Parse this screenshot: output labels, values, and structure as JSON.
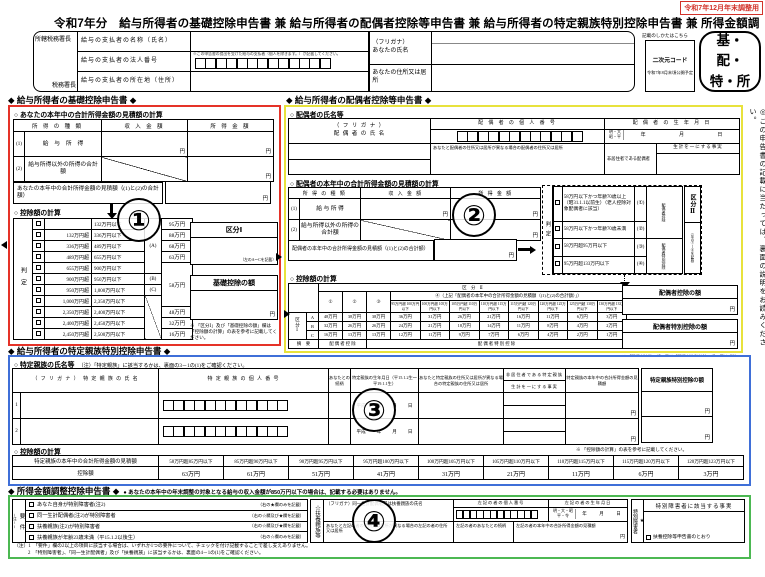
{
  "page": {
    "edition_note": "令和7年12月年末調整用",
    "title": "令和7年分　給与所得者の基礎控除申告書 兼 給与所得者の配偶者控除等申告書 兼 給与所得者の特定親族特別控除申告書 兼 所得金額調整控除申告書",
    "side_note": "◎この申告書の記載に当たっては、裏面の説明をお読みください。"
  },
  "header": {
    "tax_office_prefix": "所轄税務署長",
    "tax_office_suffix": "税務署長",
    "payer_name_label": "給与の支払者の名称（氏名）",
    "payer_number_label": "給与の支払者の法人番号",
    "payer_number_note": "※この申告書の提出を受けた給与の支払者（個人を除きます。）が記載してください。",
    "payer_address_label": "給与の支払者の所在地（住所）",
    "furigana_label": "（フリガナ）",
    "your_name_label": "あなたの氏名",
    "your_address_label": "あなたの住所又は居所",
    "qr_guide": "記載のしかたはこちら",
    "qr_label": "二次元コード",
    "qr_note": "令和7年8月末頃公開予定",
    "badge": "基・配・特・所"
  },
  "basic": {
    "heading": "◆ 給与所得者の基礎控除申告書 ◆",
    "income_title": "○ あなたの本年中の合計所得金額の見積額の計算",
    "col_type": "所 得 の 種 類",
    "col_revenue": "収 入 金 額",
    "col_amount": "所 得 金 額",
    "row1_no": "(1)",
    "row1_label": "給　与　所　得",
    "row2_no": "(2)",
    "row2_label": "給与所得以外の所得の合計額",
    "yen": "円",
    "total_label": "あなたの本年中の合計所得金額の見積額（(1)と(2)の合計額）",
    "deduction_title": "○ 控除額の計算",
    "judge_label": "判定",
    "judge_rows": [
      {
        "lo": "",
        "hi": "132万円以下"
      },
      {
        "lo": "132万円超",
        "hi": "336万円以下"
      },
      {
        "lo": "336万円超",
        "hi": "489万円以下"
      },
      {
        "lo": "489万円超",
        "hi": "655万円以下"
      },
      {
        "lo": "655万円超",
        "hi": "900万円以下"
      },
      {
        "lo": "900万円超",
        "hi": "950万円以下"
      },
      {
        "lo": "950万円超",
        "hi": "1,000万円以下"
      },
      {
        "lo": "1,000万円超",
        "hi": "2,350万円以下"
      },
      {
        "lo": "2,350万円超",
        "hi": "2,400万円以下"
      },
      {
        "lo": "2,400万円超",
        "hi": "2,450万円以下"
      },
      {
        "lo": "2,450万円超",
        "hi": "2,500万円以下"
      }
    ],
    "judge_marks": [
      {
        "text": "(A)",
        "span": 5
      },
      {
        "text": "(B)",
        "span": 1
      },
      {
        "text": "(C)",
        "span": 1
      },
      {
        "text": "",
        "span": 4
      }
    ],
    "judge_amounts": [
      {
        "text": "95万円",
        "span": 1
      },
      {
        "text": "88万円",
        "span": 1
      },
      {
        "text": "68万円",
        "span": 1
      },
      {
        "text": "63万円",
        "span": 1
      },
      {
        "text": "58万円",
        "span": 4
      },
      {
        "text": "48万円",
        "span": 1
      },
      {
        "text": "32万円",
        "span": 1
      },
      {
        "text": "16万円",
        "span": 1
      }
    ],
    "kubun1_label": "区分Ⅰ",
    "kubun1_hint": "（左のA～Cを記載）",
    "kiso_label": "基礎控除の額",
    "note": "※ 「区分Ⅰ」及び「基礎控除の額」欄は「控除額の計算」の表を参考に記載してください。",
    "circle": "①"
  },
  "spouse": {
    "heading": "◆ 給与所得者の配偶者控除等申告書 ◆",
    "name_title": "○ 配偶者の氏名等",
    "furigana_label": "（ フ リ ガ ナ ）",
    "name_label": "配 偶 者 の 氏 名",
    "number_label": "配 偶 者 の 個 人 番 号",
    "address_label": "あなたと配偶者の住所又は居所が異なる場合の配偶者の住所又は居所",
    "birth_label": "配 偶 者 の 生 年 月 日",
    "era1": "明・大",
    "era2": "昭・平",
    "year": "年",
    "month": "月",
    "day": "日",
    "nonresident_label": "非居住者である配偶者",
    "living_label": "生計を一にする事実",
    "income_title": "○ 配偶者の本年中の合計所得金額の見積額の計算",
    "col_type": "所 得 の 種 類",
    "col_revenue": "収 入 金 額",
    "col_amount": "所 得 金 額",
    "row1_no": "(1)",
    "row1_label": "給 与 所 得",
    "row2_no": "(2)",
    "row2_label": "給与所得以外の所得の合計額",
    "yen": "円",
    "total_label": "配偶者の本年中の合計所得金額の見積額（(1)と(2)の合計額）",
    "judge_label": "判定",
    "judge_rows": [
      {
        "label": "58万円以下かつ年齢70歳以上（昭31.1.1以前生）（老人控除対象配偶者に該当）",
        "mark": "(①)"
      },
      {
        "label": "58万円以下かつ年齢70歳未満",
        "mark": "(②)"
      },
      {
        "label": "58万円超95万円以下",
        "mark": "(③)"
      },
      {
        "label": "95万円超133万円以下",
        "mark": "(④)"
      }
    ],
    "judge_groups": [
      {
        "text": "配偶者控除",
        "span": 2
      },
      {
        "text": "配偶者特別控除",
        "span": 2
      }
    ],
    "kubun2_label": "区分Ⅱ",
    "kubun2_hint": "（左の①～④を記載）",
    "matrix_title": "○ 控除額の計算",
    "matrix": {
      "header": "区　分　Ⅱ",
      "cols123": [
        "①",
        "②",
        "③"
      ],
      "col4_header": "④（上記「配偶者の本年中の合計所得金額の見積額（(1)と(2)の合計額）」）",
      "col4_ranges": [
        "95万円超 100万円以下",
        "100万円超 105万円以下",
        "105万円超 110万円以下",
        "110万円超 115万円以下",
        "115万円超 120万円以下",
        "120万円超 125万円以下",
        "125万円超 130万円以下",
        "130万円超 133万円以下"
      ],
      "kubun1_label": "区分Ⅰ",
      "row_keys": [
        "A",
        "B",
        "C"
      ],
      "rows": [
        [
          "48万円",
          "38万円",
          "38万円",
          "36万円",
          "31万円",
          "26万円",
          "21万円",
          "16万円",
          "11万円",
          "6万円",
          "3万円"
        ],
        [
          "32万円",
          "26万円",
          "26万円",
          "24万円",
          "21万円",
          "18万円",
          "14万円",
          "11万円",
          "8万円",
          "4万円",
          "2万円"
        ],
        [
          "16万円",
          "13万円",
          "13万円",
          "12万円",
          "11万円",
          "9万円",
          "7万円",
          "6万円",
          "4万円",
          "2万円",
          "1万円"
        ]
      ],
      "summary_label": "摘　要",
      "summary1": "配 偶 者 控 除",
      "summary2": "配 偶 者 特 別 控 除"
    },
    "deduction1_label": "配偶者控除の額",
    "deduction2_label": "配偶者特別控除の額",
    "note": "※ 「配偶者控除の額」又は「配偶者特別控除の額」欄は「判定」及び「控除額の計算」の表を参考に記載してください。",
    "circle": "②"
  },
  "tokutei": {
    "heading": "◆ 給与所得者の特定親族特別控除申告書 ◆",
    "name_title": "○ 特定親族の氏名等",
    "name_note": "（注）「特定親族」に該当するかは、裏面の3－1の(1)をご確認ください。",
    "col_name": "（ フ リ ガ ナ ）　特 定 親 族 の 氏 名",
    "col_number": "特 定 親 族 の 個 人 番 号",
    "col_relation": "あなたとの続柄",
    "col_birth": "特定親族の生年月日（平15.1.2生～平19.1.1生）",
    "col_address": "あなたと特定親族の住所又は居所が異なる場合の特定親族の住所又は居所",
    "col_nonresident": "非居住者である特定親族",
    "col_living": "生計を一にする事実",
    "col_income": "特定親族の本年中の合計所得金額の見積額",
    "col_deduction": "特定親族特別控除の額",
    "row_numbers": [
      "1",
      "2"
    ],
    "era": "平成",
    "year": "年",
    "month": "月",
    "day": "日",
    "yen": "円",
    "note": "※ 「控除額の計算」の表を参考に記載してください。",
    "calc_title": "○ 控除額の計算",
    "calc_label": "特定親族の本年中の合計所得金額の見積額",
    "calc_row_label": "控除額",
    "ranges": [
      "58万円超85万円以下",
      "85万円超90万円以下",
      "90万円超95万円以下",
      "95万円超100万円以下",
      "100万円超105万円以下",
      "105万円超110万円以下",
      "110万円超115万円以下",
      "115万円超120万円以下",
      "120万円超123万円以下"
    ],
    "amounts": [
      "63万円",
      "61万円",
      "51万円",
      "41万円",
      "31万円",
      "21万円",
      "11万円",
      "6万円",
      "3万円"
    ],
    "circle": "③"
  },
  "chosei": {
    "heading": "◆ 所得金額調整控除申告書 ◆",
    "heading_note": "● あなたの本年中の年末調整の対象となる給与の収入金額が850万円以下の場合は、記載する必要はありません。",
    "yoken_label": "要　件",
    "yoken_ref": "(注1)",
    "requirements": [
      {
        "label": "あなた自身が特別障害者(注2)",
        "hint": "（右の★欄のみを記載）"
      },
      {
        "label": "同一生計配偶者(注2)が特別障害者",
        "hint": "（右の☆欄及び★欄を記載）"
      },
      {
        "label": "扶養親族(注2)が特別障害者",
        "hint": "（右の☆欄及び★欄を記載）"
      },
      {
        "label": "扶養親族が年齢23歳未満（平15.1.2以後生）",
        "hint": "（右の☆欄のみを記載）"
      }
    ],
    "fuyo_label": "☆扶養親族等",
    "name_label": "（フリガナ）同一生計配偶者又は扶養親族の氏名",
    "number_label": "左記の者の個人番号",
    "birth_label": "左記の者の生年月日",
    "era1": "明・大・昭",
    "era2": "平・令",
    "year": "年",
    "month": "月",
    "day": "日",
    "address_label": "あなたと左記の者の住所又は居所が異なる場合の左記の者の住所又は居所",
    "relation_label": "左記の者のあなたとの続柄",
    "income_label": "左記の者の本年中の合計所得金額の見積額",
    "yen": "円",
    "tokusho_star": "★",
    "tokusho_label": "特別障害者",
    "fact_label": "特別障害者に該当する事実",
    "fact_option": "扶養控除等申告書のとおり",
    "notes": [
      "（注）1　「要件」欄の2以上の項目に該当する場合は、いずれか1つの要件について、チェックを付け記載することで差し支えありません。",
      "2　「特別障害者」、「同一生計配偶者」及び「扶養親族」に該当するかは、裏面の4－1の(1)をご確認ください。"
    ],
    "circle": "④"
  }
}
